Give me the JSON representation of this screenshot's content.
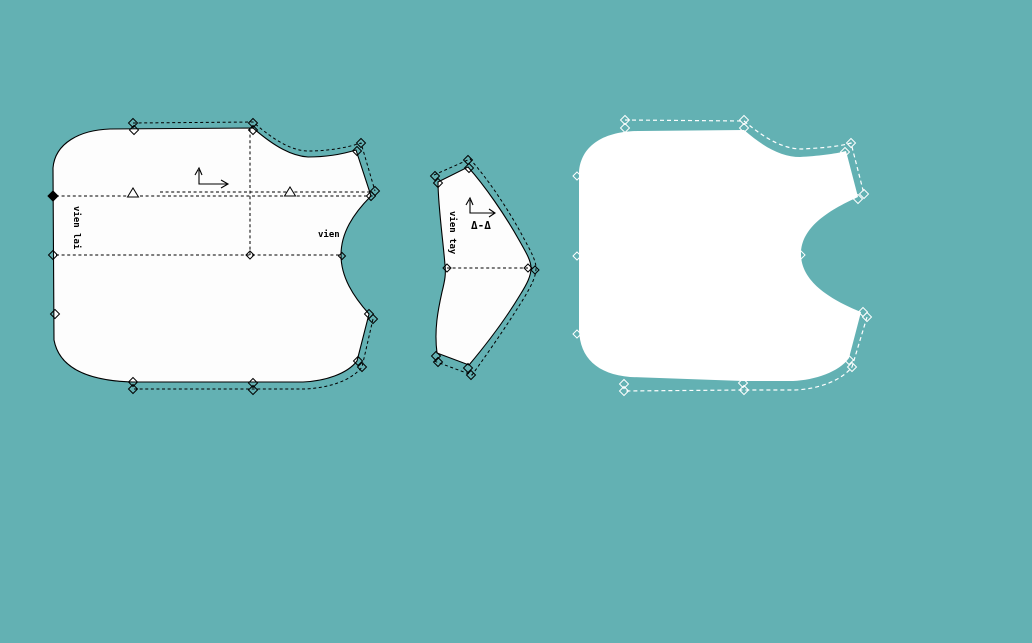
{
  "canvas": {
    "background_color": "#63b1b3",
    "piece_fill_color": "#fdfdfd",
    "outline_color": "#000000",
    "right_piece_line_color": "#ffffff"
  },
  "labels": {
    "left_piece_edge": "vien lai",
    "left_piece_armhole": "vien",
    "middle_piece_edge": "vien tay",
    "middle_piece_notch_symbol": "Δ-Δ"
  },
  "marker_groups": [
    {
      "svg_id": "left-markers",
      "name": "left-piece-notch-diamond",
      "color": "#000000",
      "items": [
        {
          "x": 133,
          "y": 123
        },
        {
          "x": 134,
          "y": 130
        },
        {
          "x": 253,
          "y": 123
        },
        {
          "x": 253,
          "y": 130
        },
        {
          "x": 361,
          "y": 143
        },
        {
          "x": 357,
          "y": 151
        },
        {
          "x": 375,
          "y": 191
        },
        {
          "x": 371,
          "y": 196
        },
        {
          "x": 373,
          "y": 319
        },
        {
          "x": 369,
          "y": 314
        },
        {
          "x": 362,
          "y": 367
        },
        {
          "x": 358,
          "y": 361
        },
        {
          "x": 253,
          "y": 390
        },
        {
          "x": 253,
          "y": 383
        },
        {
          "x": 133,
          "y": 389
        },
        {
          "x": 133,
          "y": 382
        },
        {
          "x": 53,
          "y": 196,
          "s": 5,
          "filled": true
        },
        {
          "x": 53,
          "y": 255
        },
        {
          "x": 55,
          "y": 314
        },
        {
          "x": 250,
          "y": 255,
          "s": 4
        },
        {
          "x": 342,
          "y": 256,
          "s": 3.5
        }
      ]
    },
    {
      "svg_id": "middle-markers",
      "name": "middle-piece-notch-diamond",
      "color": "#000000",
      "items": [
        {
          "x": 435,
          "y": 176
        },
        {
          "x": 438,
          "y": 183
        },
        {
          "x": 468,
          "y": 160
        },
        {
          "x": 469,
          "y": 168
        },
        {
          "x": 436,
          "y": 356
        },
        {
          "x": 438,
          "y": 362
        },
        {
          "x": 468,
          "y": 368
        },
        {
          "x": 471,
          "y": 375
        },
        {
          "x": 447,
          "y": 268,
          "s": 4
        },
        {
          "x": 528,
          "y": 268,
          "s": 4
        },
        {
          "x": 535,
          "y": 270,
          "s": 4
        }
      ]
    },
    {
      "svg_id": "right-markers",
      "name": "right-piece-notch-diamond",
      "color": "#ffffff",
      "items": [
        {
          "x": 625,
          "y": 120
        },
        {
          "x": 625,
          "y": 128
        },
        {
          "x": 744,
          "y": 120
        },
        {
          "x": 744,
          "y": 128
        },
        {
          "x": 851,
          "y": 143
        },
        {
          "x": 845,
          "y": 152
        },
        {
          "x": 864,
          "y": 194
        },
        {
          "x": 858,
          "y": 199
        },
        {
          "x": 801,
          "y": 255,
          "s": 4
        },
        {
          "x": 863,
          "y": 312
        },
        {
          "x": 867,
          "y": 317
        },
        {
          "x": 849,
          "y": 360
        },
        {
          "x": 852,
          "y": 367
        },
        {
          "x": 743,
          "y": 383
        },
        {
          "x": 744,
          "y": 390
        },
        {
          "x": 624,
          "y": 384
        },
        {
          "x": 624,
          "y": 391
        },
        {
          "x": 577,
          "y": 176,
          "s": 4
        },
        {
          "x": 577,
          "y": 256,
          "s": 4
        },
        {
          "x": 577,
          "y": 334,
          "s": 4
        }
      ]
    }
  ],
  "triangle_groups": [
    {
      "svg_id": "left-triangles",
      "name": "left-piece-notch-triangle",
      "color": "#000000",
      "items": [
        {
          "x": 133,
          "y": 197,
          "w": 11,
          "h": 9
        },
        {
          "x": 290,
          "y": 196,
          "w": 11,
          "h": 9
        }
      ]
    }
  ]
}
